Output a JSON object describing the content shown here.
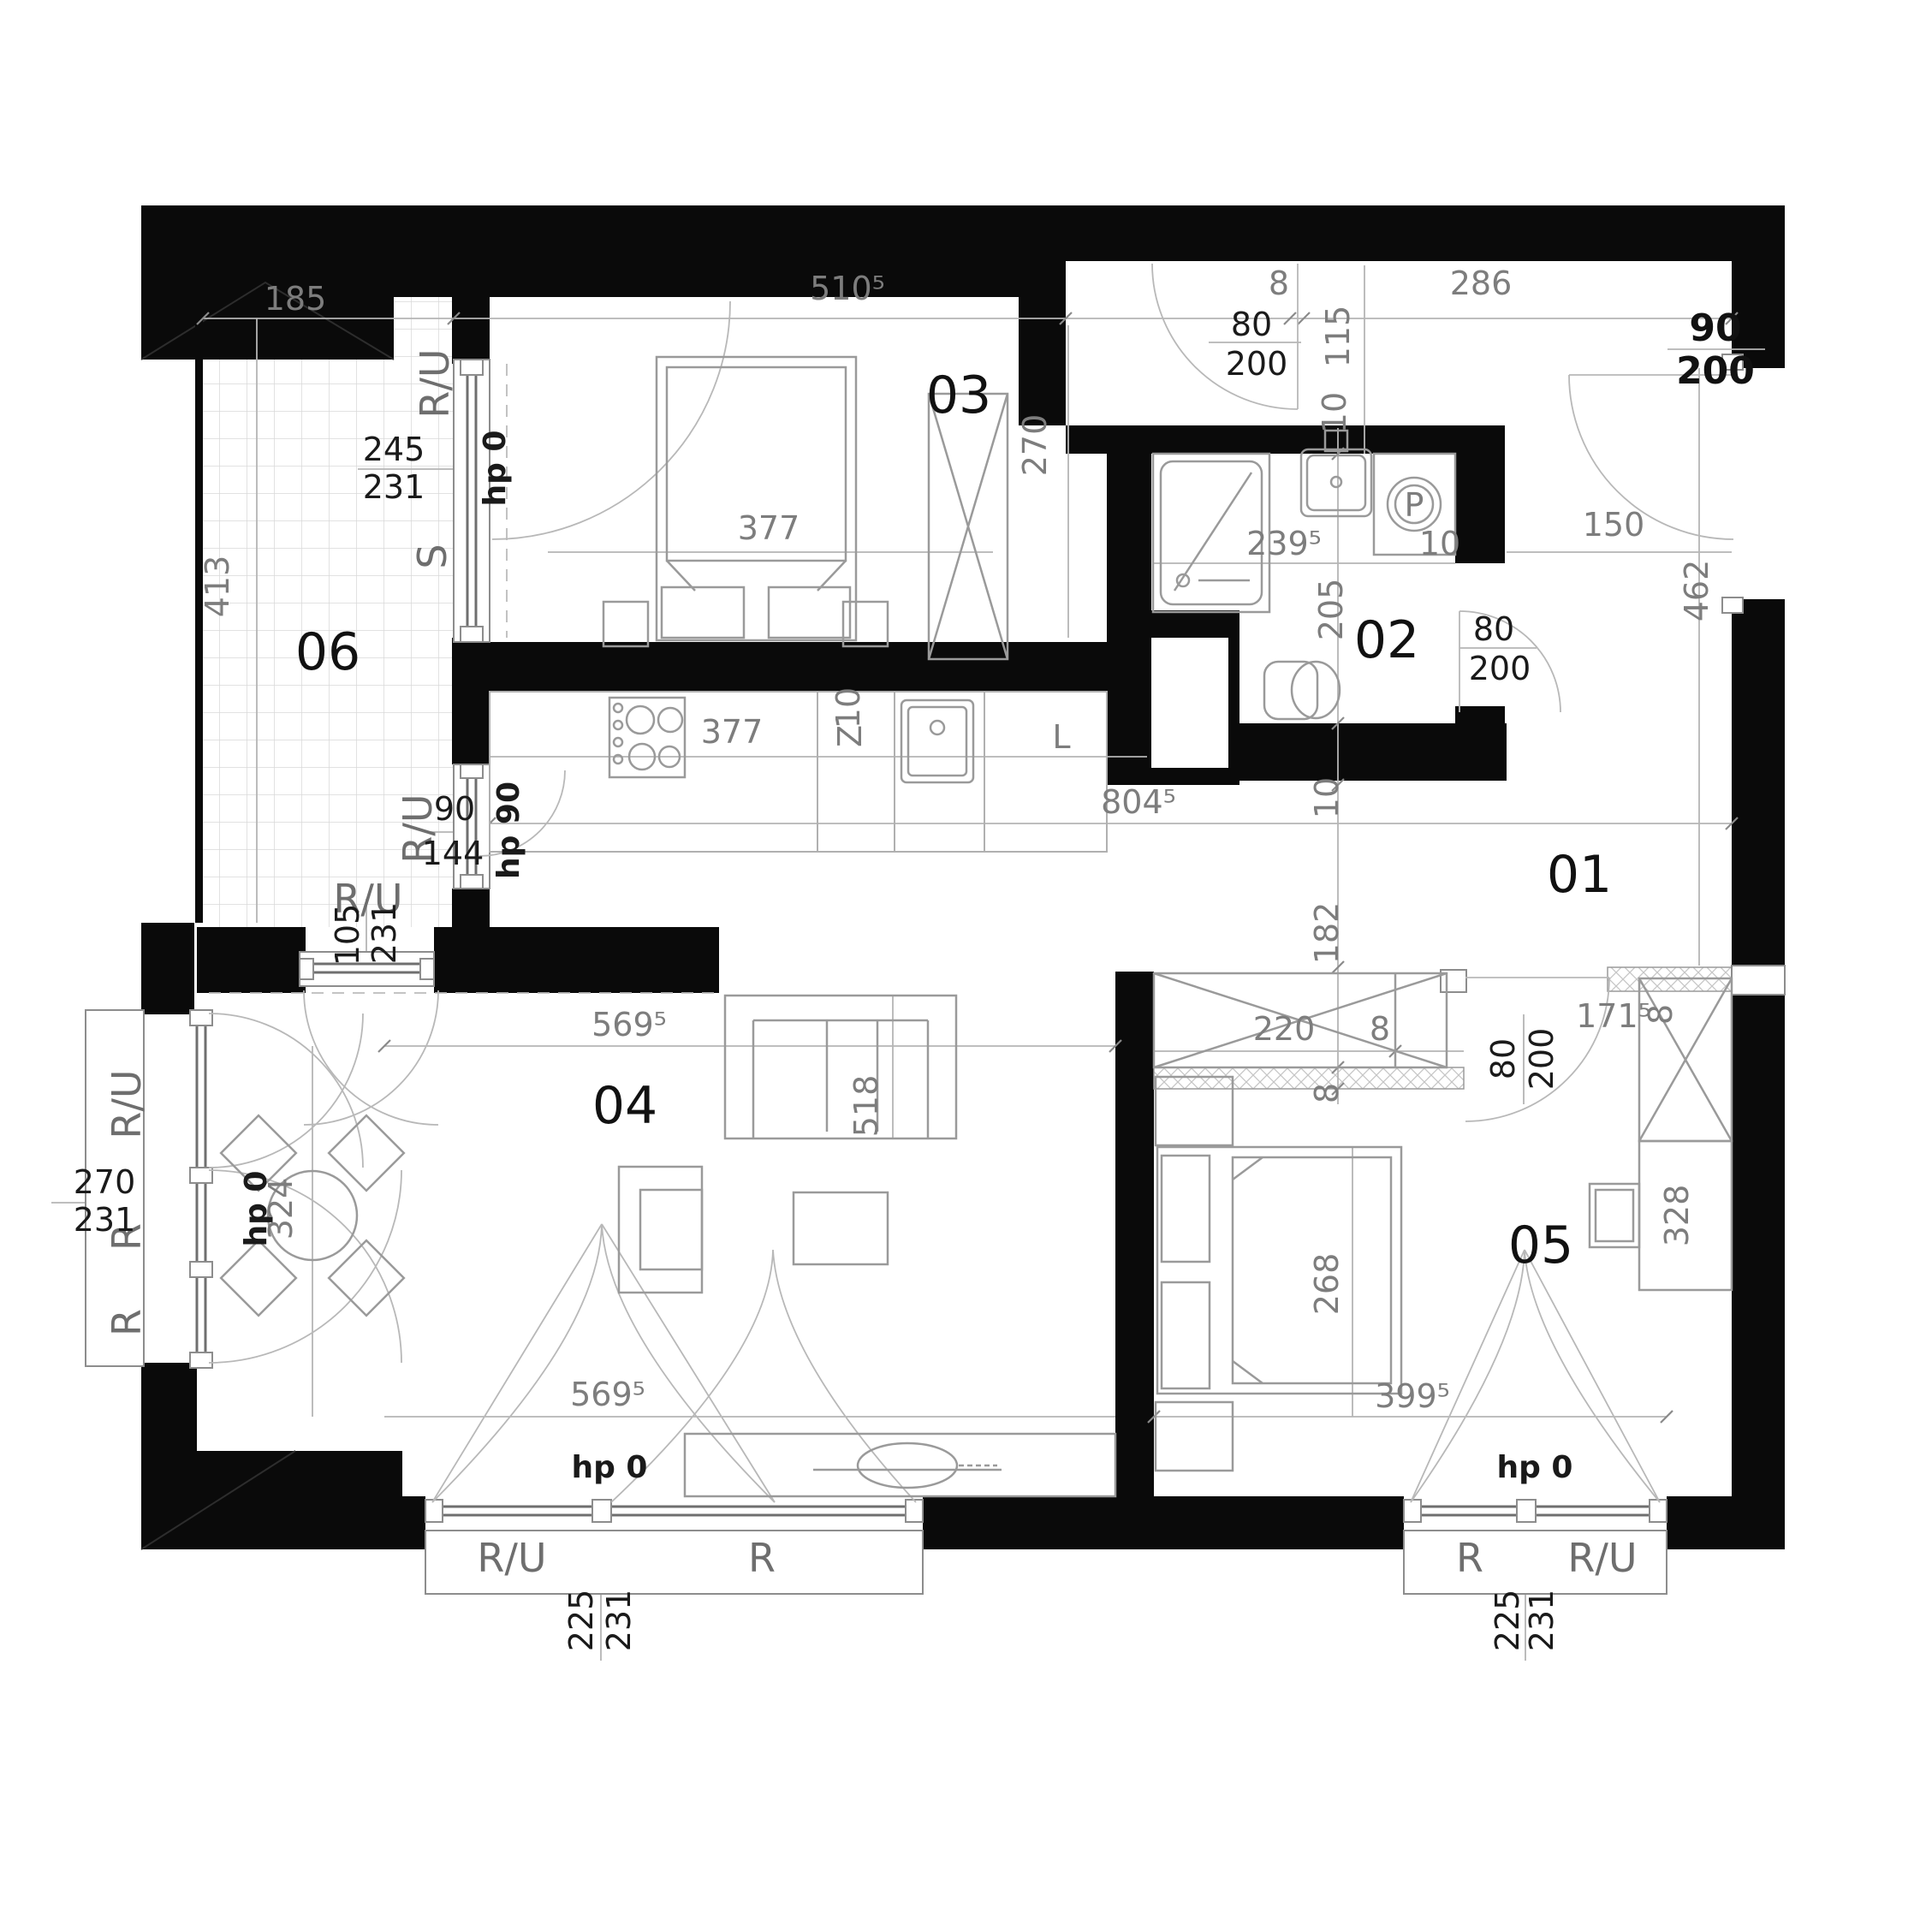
{
  "rooms": {
    "r01": "01",
    "r02": "02",
    "r03": "03",
    "r04": "04",
    "r05": "05",
    "r06": "06"
  },
  "dims": {
    "d185": "185",
    "d5105": "510⁵",
    "d8top": "8",
    "d286": "286",
    "d115": "115",
    "d10entry": "10",
    "d2395": "239⁵",
    "d10bath": "10",
    "d150": "150",
    "d462": "462",
    "d8045": "804⁵",
    "d10wall": "10",
    "d182": "182",
    "d205": "205",
    "d270r3": "270",
    "d377bed": "377",
    "d377kit": "377",
    "d413": "413",
    "d324": "324",
    "d220": "220",
    "d8w": "8",
    "d8h": "8",
    "d8r": "8",
    "d1715": "171⁵",
    "d5695t": "569⁵",
    "d518": "518",
    "d5695b": "569⁵",
    "d268": "268",
    "d3995": "399⁵",
    "d328": "328"
  },
  "windows": {
    "ru_balc": "R/U",
    "s_balc": "S",
    "hp0_balc": "hp 0",
    "d245": "245",
    "d231balc": "231",
    "ru90": "R/U",
    "d90": "90",
    "d144": "144",
    "hp90": "hp 90",
    "ru105": "R/U",
    "d105": "105",
    "d231w105": "231",
    "hp0_105": "hp 0",
    "ruL": "R/U",
    "rL1": "R",
    "rL2": "R",
    "d270L": "270",
    "d231L": "231",
    "hp0L": "hp 0",
    "ru_bl": "R/U",
    "r_bl": "R",
    "d225bl": "225",
    "d231bl": "231",
    "hp0_bl": "hp 0",
    "r_br": "R",
    "ru_br": "R/U",
    "d225br": "225",
    "d231br": "231",
    "hp0_br": "hp 0"
  },
  "doors": {
    "d80top": "80",
    "d200top": "200",
    "d90e": "90",
    "d200e": "200",
    "d80bath": "80",
    "d200bath": "200",
    "d80r5": "80",
    "d200r5": "200"
  },
  "kitchen": {
    "z": "Z",
    "z10": "10",
    "l": "L"
  },
  "fixtures": {
    "p": "P"
  }
}
